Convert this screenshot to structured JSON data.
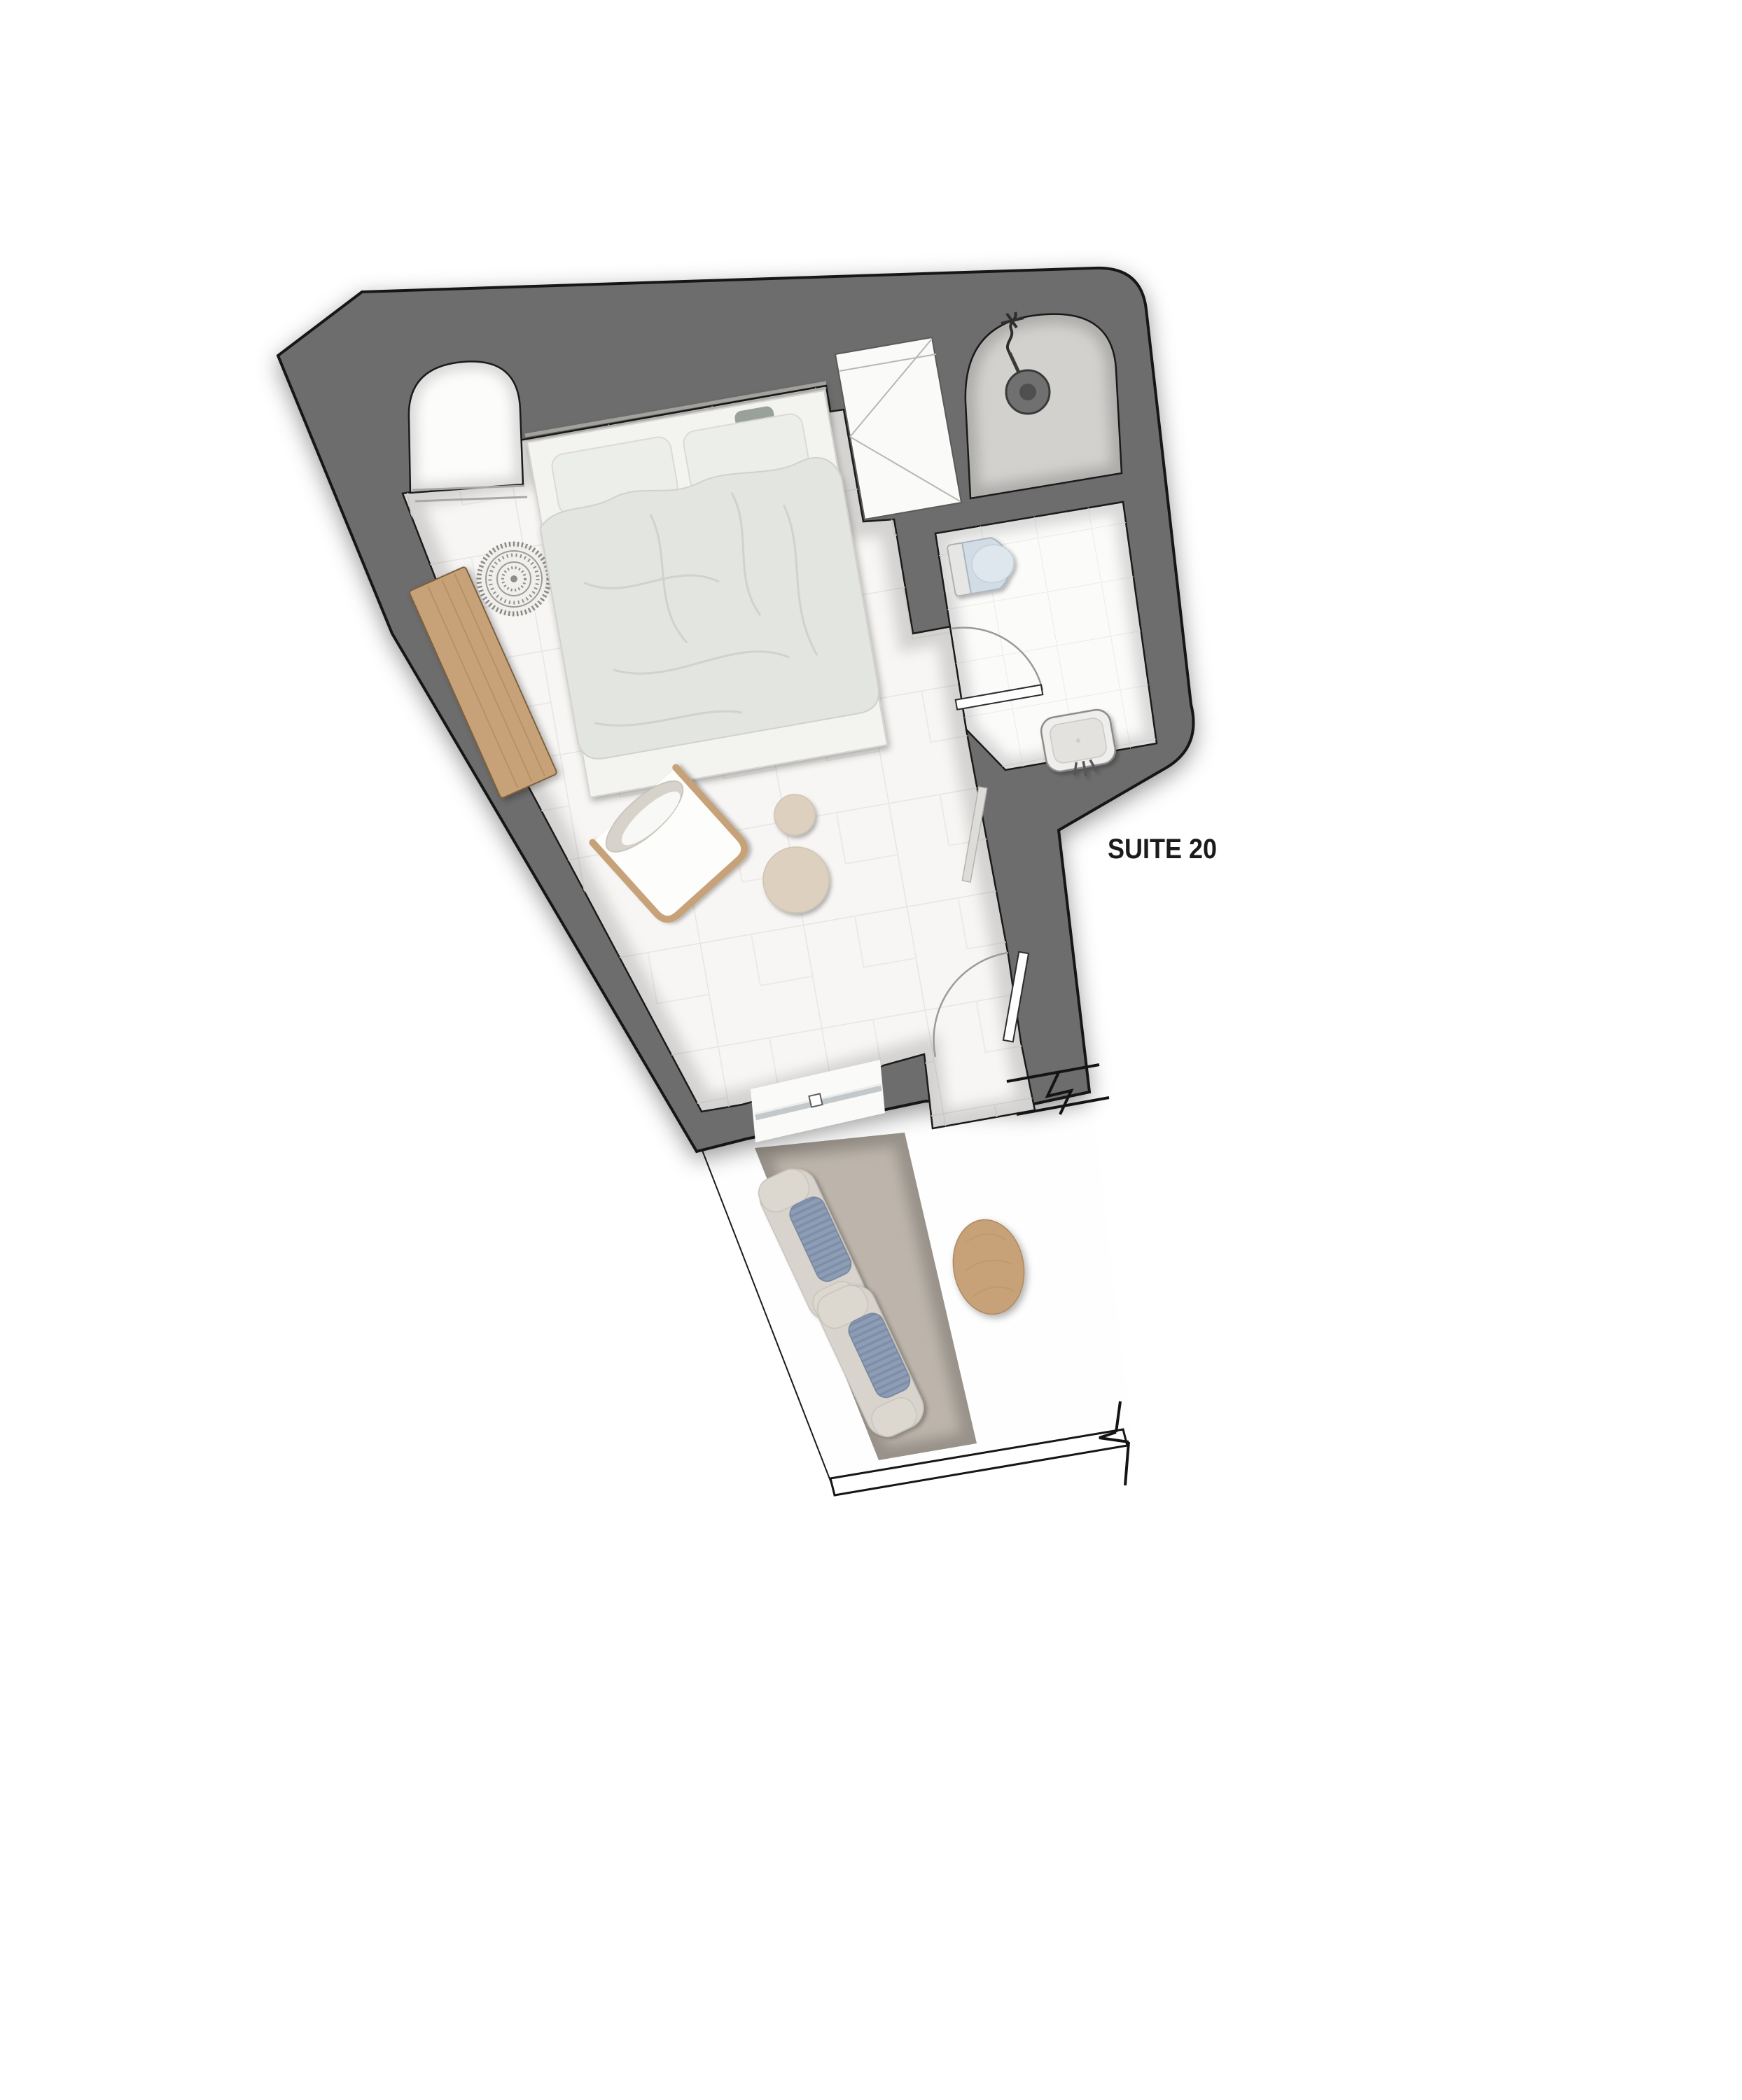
{
  "plan": {
    "label": "SUITE 20"
  },
  "colors": {
    "background": "#ffffff",
    "wall": "#6d6d6d",
    "wall_outline": "#161616",
    "floor_bedroom": "#f7f6f4",
    "floor_bath": "#fbfbfa",
    "floor_shower": "#d3d1ce",
    "floor_niche": "#fcfcfb",
    "tile_line": "#e6e5e2",
    "carpet": "#bdb5ab",
    "wood": "#c7a278",
    "wood_dark": "#7d5f3e",
    "rug": "#8e8e8b",
    "pouf": "#ddd0bf",
    "duvet": "#e3e5e1",
    "pillow": "#eceeea",
    "mattress": "#f3f3f0",
    "throw": "#9aa09c",
    "lounger_mat": "#d8d4cd",
    "lounger_cushion": "#8d9db5",
    "lounger_stripe": "#7d8ea6",
    "lounger_pillow": "#ddd8cf",
    "toilet": "#d2dce5",
    "sink": "#efeeec",
    "glass": "#c3c8cb",
    "label_text": "#1b1b1b"
  },
  "furniture": {
    "bedroom": [
      "double-bed",
      "pillows",
      "duvet",
      "wooden-bench",
      "round-rug",
      "lounge-chair",
      "side-table-small",
      "side-table-large",
      "wardrobe",
      "wall-shelf"
    ],
    "bathroom": [
      "walk-in-shower",
      "shower-head",
      "toilet",
      "washbasin",
      "bathroom-door"
    ],
    "terrace": [
      "outdoor-carpet",
      "sun-lounger",
      "sun-lounger",
      "terrace-table"
    ],
    "openings": [
      "arched-niche",
      "sliding-glass-door",
      "entry-door",
      "wall-break-mark",
      "wall-break-mark"
    ]
  }
}
